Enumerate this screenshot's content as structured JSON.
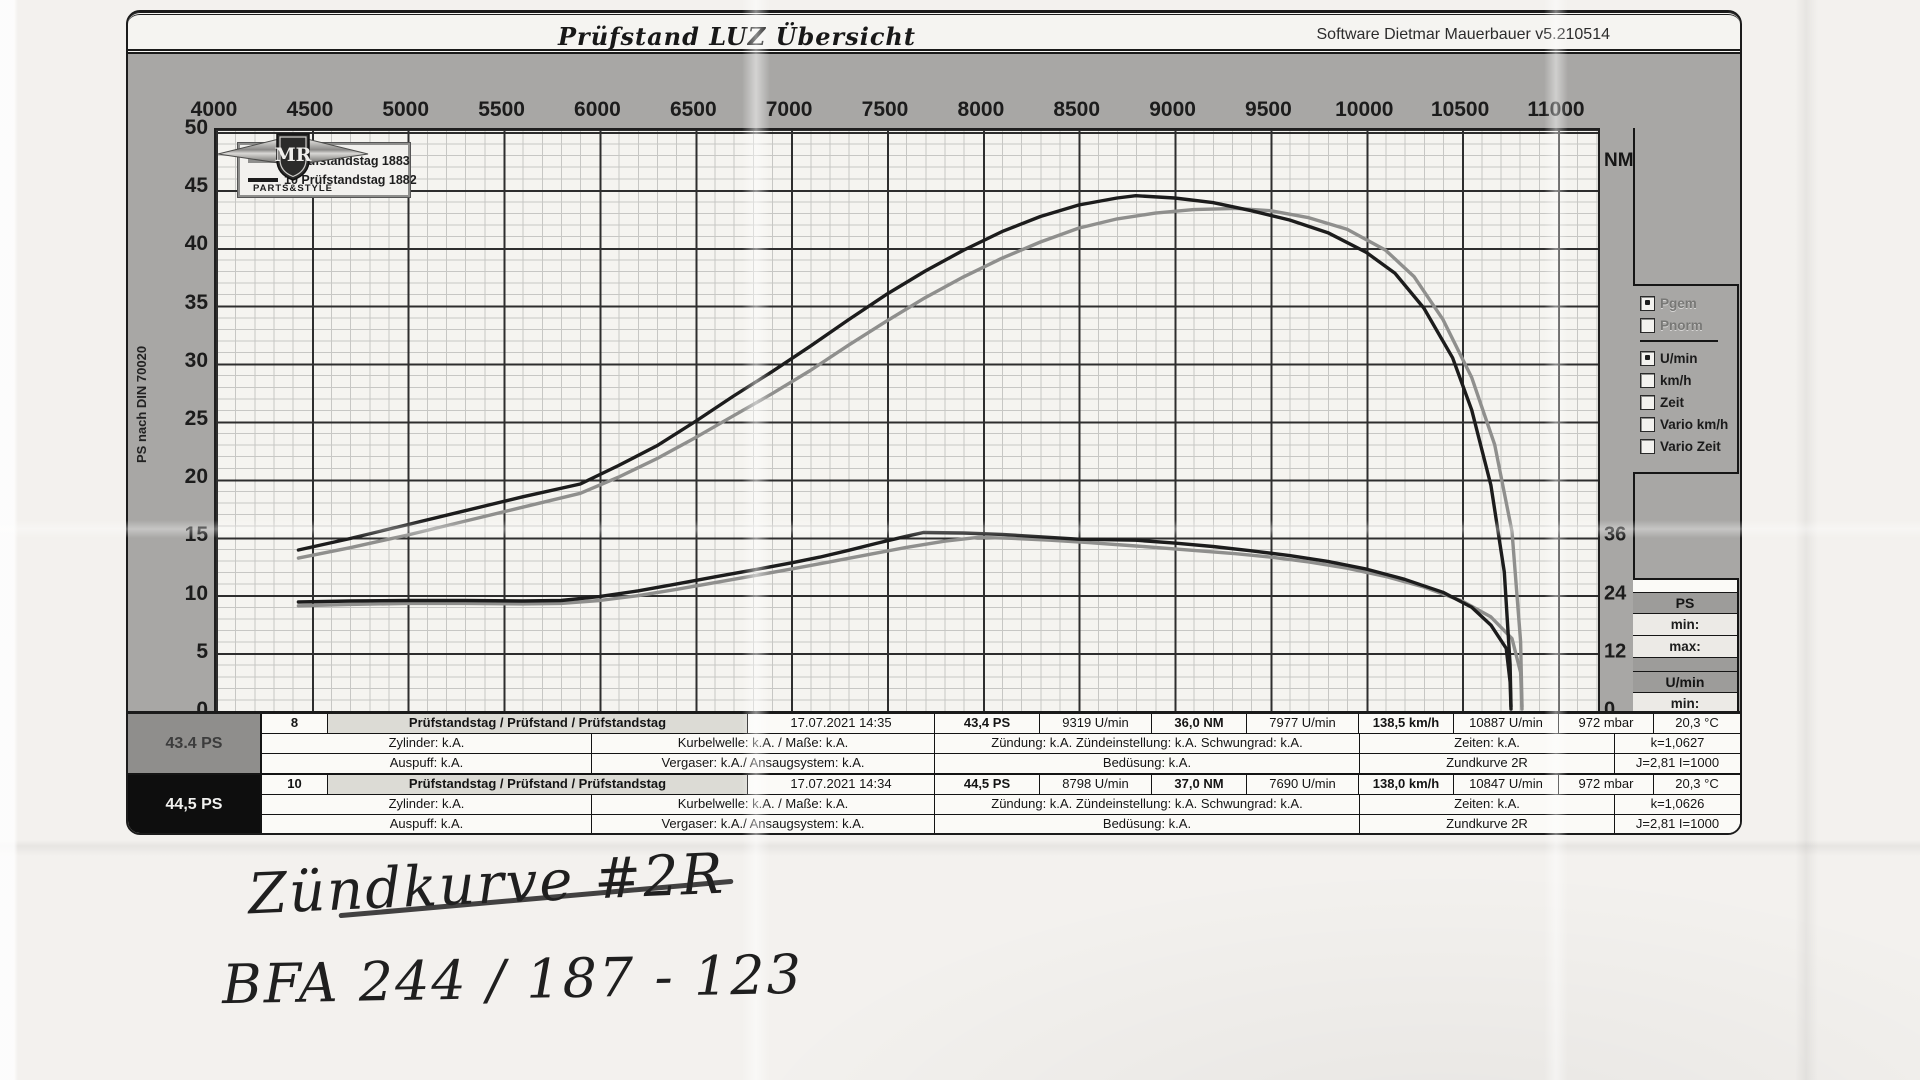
{
  "header": {
    "title": "Prüfstand LUZ  Übersicht",
    "software": "Software Dietmar Mauerbauer v5.210514"
  },
  "legend": [
    {
      "label": "8  Prüfstandstag 1883",
      "color": "#8f8f8d"
    },
    {
      "label": "10  Prüfstandstag 1882",
      "color": "#1c1c1c"
    }
  ],
  "axes": {
    "x_ticks": [
      4000,
      4500,
      5000,
      5500,
      6000,
      6500,
      7000,
      7500,
      8000,
      8500,
      9000,
      9500,
      10000,
      10500,
      11000
    ],
    "y_left_ticks": [
      50,
      45,
      40,
      35,
      30,
      25,
      20,
      15,
      10,
      5,
      0
    ],
    "y_right_ticks": [
      36,
      24,
      12,
      0
    ],
    "y_left_title": "PS nach DIN 70020",
    "y_right_unit": "NM",
    "x_title": "Kurbelwelle U/min"
  },
  "logo": {
    "monogram": "MR",
    "subtitle": "PARTS&STYLE"
  },
  "checkboxes": [
    {
      "label": "Pgem",
      "checked": true,
      "muted": true,
      "divider_after": false
    },
    {
      "label": "Pnorm",
      "checked": false,
      "muted": true,
      "divider_after": true
    },
    {
      "label": "U/min",
      "checked": true,
      "muted": false,
      "divider_after": false
    },
    {
      "label": "km/h",
      "checked": false,
      "muted": false,
      "divider_after": false
    },
    {
      "label": "Zeit",
      "checked": false,
      "muted": false,
      "divider_after": false
    },
    {
      "label": "Vario km/h",
      "checked": false,
      "muted": false,
      "divider_after": false
    },
    {
      "label": "Vario Zeit",
      "checked": false,
      "muted": false,
      "divider_after": false
    }
  ],
  "side_stats": [
    {
      "title": "PS",
      "rows": [
        "min:",
        "max:"
      ]
    },
    {
      "title": "U/min",
      "rows": [
        "min:",
        "max:"
      ]
    }
  ],
  "table": {
    "blocks": [
      {
        "side_label": "43.4 PS",
        "side_style": "gray",
        "num": "8",
        "desc": "Prüfstandstag / Prüfstand / Prüfstandstag",
        "date": "17.07.2021 14:35",
        "ps": "43,4 PS",
        "rpm_ps": "9319 U/min",
        "nm": "36,0 NM",
        "rpm_nm": "7977 U/min",
        "kmh": "138,5 km/h",
        "rpm_max": "10887 U/min",
        "mbar": "972 mbar",
        "temp": "20,3 °C",
        "zylinder": "Zylinder: k.A.",
        "kurbelwelle": "Kurbelwelle: k.A. / Maße: k.A.",
        "zuendung": "Zündung: k.A.  Zündeinstellung: k.A. Schwungrad: k.A.",
        "zeiten": "Zeiten: k.A.",
        "k": "k=1,0627",
        "auspuff": "Auspuff: k.A.",
        "vergaser": "Vergaser: k.A./ Ansaugsystem: k.A.",
        "beduesung": "Bedüsung: k.A.",
        "zundkurve": "Zundkurve 2R",
        "j": "J=2,81 I=1000"
      },
      {
        "side_label": "44,5 PS",
        "side_style": "black",
        "num": "10",
        "desc": "Prüfstandstag / Prüfstand / Prüfstandstag",
        "date": "17.07.2021 14:34",
        "ps": "44,5 PS",
        "rpm_ps": "8798 U/min",
        "nm": "37,0 NM",
        "rpm_nm": "7690 U/min",
        "kmh": "138,0 km/h",
        "rpm_max": "10847 U/min",
        "mbar": "972 mbar",
        "temp": "20,3 °C",
        "zylinder": "Zylinder: k.A.",
        "kurbelwelle": "Kurbelwelle: k.A. / Maße: k.A.",
        "zuendung": "Zündung: k.A.  Zündeinstellung: k.A. Schwungrad: k.A.",
        "zeiten": "Zeiten: k.A.",
        "k": "k=1,0626",
        "auspuff": "Auspuff: k.A.",
        "vergaser": "Vergaser: k.A./ Ansaugsystem: k.A.",
        "beduesung": "Bedüsung: k.A.",
        "zundkurve": "Zundkurve 2R",
        "j": "J=2,81 I=1000"
      }
    ]
  },
  "handwriting": {
    "line1": "Zündkurve #2R",
    "line2": "BFA 244   / 187 - 123"
  },
  "chart_data": {
    "type": "line",
    "title": "Prüfstand LUZ Übersicht",
    "xlabel": "Kurbelwelle U/min",
    "ylabel_left": "PS nach DIN 70020",
    "ylabel_right": "NM",
    "x_range": [
      4000,
      11000
    ],
    "y_left_range": [
      0,
      50
    ],
    "y_right_nm_per_ps": 2.4,
    "grid": true,
    "legend_position": "top-left",
    "series": [
      {
        "name": "8 Prüfstandstag 1883",
        "role": "power",
        "unit": "PS",
        "color": "#8f8f8d",
        "peak": {
          "value": 43.4,
          "rpm": 9319
        },
        "points": [
          [
            4430,
            13.2
          ],
          [
            4700,
            14.1
          ],
          [
            5000,
            15.2
          ],
          [
            5300,
            16.4
          ],
          [
            5600,
            17.6
          ],
          [
            5900,
            18.8
          ],
          [
            6100,
            20.2
          ],
          [
            6300,
            21.8
          ],
          [
            6500,
            23.6
          ],
          [
            6700,
            25.5
          ],
          [
            6900,
            27.4
          ],
          [
            7100,
            29.4
          ],
          [
            7300,
            31.6
          ],
          [
            7500,
            33.7
          ],
          [
            7700,
            35.7
          ],
          [
            7900,
            37.5
          ],
          [
            8100,
            39.1
          ],
          [
            8300,
            40.5
          ],
          [
            8500,
            41.7
          ],
          [
            8700,
            42.5
          ],
          [
            8900,
            43.0
          ],
          [
            9100,
            43.3
          ],
          [
            9319,
            43.4
          ],
          [
            9500,
            43.2
          ],
          [
            9700,
            42.6
          ],
          [
            9900,
            41.6
          ],
          [
            10100,
            39.8
          ],
          [
            10250,
            37.5
          ],
          [
            10400,
            33.8
          ],
          [
            10550,
            28.8
          ],
          [
            10670,
            23.0
          ],
          [
            10760,
            15.5
          ],
          [
            10805,
            6.0
          ],
          [
            10812,
            0.4
          ]
        ]
      },
      {
        "name": "8 Prüfstandstag 1883",
        "role": "torque",
        "unit": "NM",
        "color": "#8f8f8d",
        "peak": {
          "value": 36.0,
          "rpm": 7977
        },
        "points": [
          [
            4430,
            21.8
          ],
          [
            4700,
            22.1
          ],
          [
            5000,
            22.3
          ],
          [
            5300,
            22.3
          ],
          [
            5600,
            22.2
          ],
          [
            5800,
            22.3
          ],
          [
            6000,
            22.9
          ],
          [
            6200,
            23.9
          ],
          [
            6400,
            25.2
          ],
          [
            6600,
            26.6
          ],
          [
            6800,
            28.0
          ],
          [
            7000,
            29.4
          ],
          [
            7200,
            30.9
          ],
          [
            7400,
            32.4
          ],
          [
            7600,
            33.9
          ],
          [
            7800,
            35.2
          ],
          [
            7977,
            36.0
          ],
          [
            8150,
            35.8
          ],
          [
            8350,
            35.4
          ],
          [
            8550,
            34.9
          ],
          [
            8800,
            34.2
          ],
          [
            9000,
            33.6
          ],
          [
            9319,
            32.6
          ],
          [
            9500,
            31.9
          ],
          [
            9700,
            30.9
          ],
          [
            9900,
            29.6
          ],
          [
            10100,
            27.9
          ],
          [
            10300,
            25.7
          ],
          [
            10500,
            22.8
          ],
          [
            10650,
            19.5
          ],
          [
            10760,
            15.0
          ],
          [
            10805,
            8.0
          ],
          [
            10812,
            0.4
          ]
        ]
      },
      {
        "name": "10 Prüfstandstag 1882",
        "role": "power",
        "unit": "PS",
        "color": "#1c1c1c",
        "peak": {
          "value": 44.5,
          "rpm": 8798
        },
        "points": [
          [
            4430,
            13.9
          ],
          [
            4700,
            14.9
          ],
          [
            5000,
            16.1
          ],
          [
            5300,
            17.3
          ],
          [
            5600,
            18.5
          ],
          [
            5900,
            19.6
          ],
          [
            6100,
            21.2
          ],
          [
            6300,
            22.9
          ],
          [
            6500,
            25.0
          ],
          [
            6700,
            27.2
          ],
          [
            6900,
            29.3
          ],
          [
            7100,
            31.5
          ],
          [
            7300,
            33.8
          ],
          [
            7500,
            36.0
          ],
          [
            7700,
            38.0
          ],
          [
            7900,
            39.8
          ],
          [
            8100,
            41.4
          ],
          [
            8300,
            42.7
          ],
          [
            8500,
            43.7
          ],
          [
            8700,
            44.3
          ],
          [
            8798,
            44.5
          ],
          [
            9000,
            44.3
          ],
          [
            9200,
            43.9
          ],
          [
            9400,
            43.2
          ],
          [
            9600,
            42.4
          ],
          [
            9800,
            41.3
          ],
          [
            10000,
            39.6
          ],
          [
            10150,
            37.8
          ],
          [
            10300,
            34.8
          ],
          [
            10450,
            30.5
          ],
          [
            10550,
            26.0
          ],
          [
            10650,
            19.5
          ],
          [
            10720,
            12.0
          ],
          [
            10750,
            4.0
          ],
          [
            10755,
            0.4
          ]
        ]
      },
      {
        "name": "10 Prüfstandstag 1882",
        "role": "torque",
        "unit": "NM",
        "color": "#1c1c1c",
        "peak": {
          "value": 37.0,
          "rpm": 7690
        },
        "points": [
          [
            4430,
            22.6
          ],
          [
            4700,
            22.8
          ],
          [
            5000,
            22.9
          ],
          [
            5300,
            22.9
          ],
          [
            5600,
            22.8
          ],
          [
            5800,
            22.9
          ],
          [
            6000,
            23.7
          ],
          [
            6200,
            24.9
          ],
          [
            6400,
            26.3
          ],
          [
            6600,
            27.8
          ],
          [
            6800,
            29.2
          ],
          [
            7000,
            30.7
          ],
          [
            7150,
            31.9
          ],
          [
            7300,
            33.3
          ],
          [
            7450,
            34.8
          ],
          [
            7600,
            36.2
          ],
          [
            7690,
            37.0
          ],
          [
            7900,
            36.9
          ],
          [
            8100,
            36.6
          ],
          [
            8300,
            36.1
          ],
          [
            8500,
            35.6
          ],
          [
            8798,
            35.4
          ],
          [
            9000,
            34.8
          ],
          [
            9200,
            34.1
          ],
          [
            9400,
            33.2
          ],
          [
            9600,
            32.2
          ],
          [
            9800,
            31.0
          ],
          [
            10000,
            29.4
          ],
          [
            10200,
            27.3
          ],
          [
            10400,
            24.6
          ],
          [
            10550,
            21.5
          ],
          [
            10650,
            17.8
          ],
          [
            10730,
            13.0
          ],
          [
            10750,
            6.0
          ],
          [
            10755,
            0.4
          ]
        ]
      }
    ]
  }
}
